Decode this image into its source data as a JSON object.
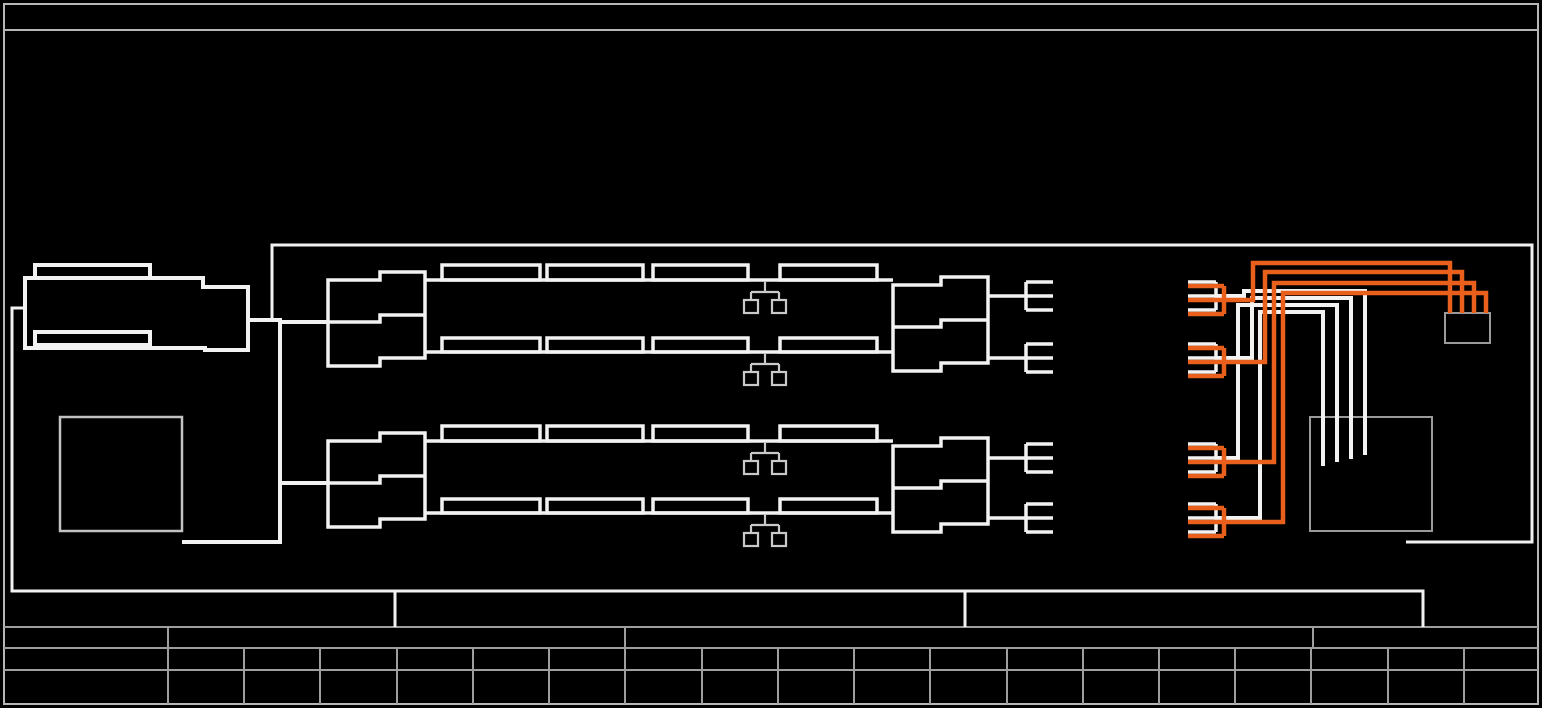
{
  "drawing": {
    "kind": "wiring-harness-schematic-sheet",
    "background": "#000000",
    "colors": {
      "frame": "#b6b6b6",
      "table": "#9e9e9e",
      "line": "#f2f2f2",
      "highlight": "#e8601c",
      "box": "#9a9a9a",
      "symbol": "#c9c9c9",
      "square": "#c2c2c2"
    },
    "title_strip_text": "",
    "title_block": {
      "rows": 3,
      "top_row_cells": 4,
      "grid_columns": 19,
      "cell_text": ""
    },
    "components": {
      "battery_connector_blocks": 1,
      "left_component_boxes": 1,
      "harness_rows": 2,
      "rails_per_harness": 2,
      "modules_per_rail": 4,
      "branch_drop_symbols": 4,
      "mid_fork_connectors": 4,
      "right_connector_pairs": 4,
      "white_wires": 4,
      "orange_wires": 4,
      "small_junction_boxes": 1,
      "large_junction_boxes": 1
    }
  }
}
